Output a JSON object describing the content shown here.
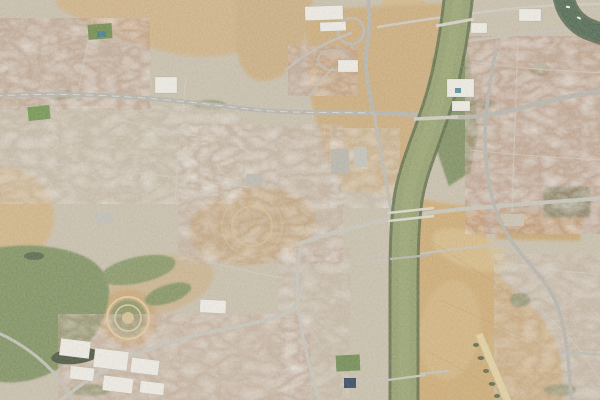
{
  "scene": {
    "type": "satellite-imagery-tile",
    "alt": "Aerial satellite view of a city crossed vertically by an olive-green river; dense rooftops on both banks, a large dry field with a runway strip southeast of the river, parks and ponds to the southwest, highway interchanges north and east, and five bridges crossing the river",
    "palette": {
      "urban_base": "#cbc2ae",
      "sand": "#cfae7c",
      "sand_light": "#dcc28e",
      "field": "#d0ad75",
      "dirt": "#c9a772",
      "river": "#94a06d",
      "river_trees": "#5c6c45",
      "dark_water": "#4d6750",
      "park": "#83945c",
      "park_dark": "#55693f",
      "pond": "#46523c",
      "road": "#c9c7bd",
      "highway": "#b7b6ae",
      "bridge": "#dcdad0",
      "building_white": "#f1efe7",
      "roof_red": "#bc9480",
      "runway": "#e4d2a2"
    },
    "features": {
      "river": "river channel",
      "old_river_arm": "dark water arm, top right",
      "bridge_count": 5,
      "dry_field": "large dry field with runway strip",
      "park_with_ponds": "green park and golf area, southwest",
      "ring_park": "circular park with concentric paths",
      "interchange": "highway interchange, top center",
      "warehouse_district": "white warehouse roofs, bottom left"
    }
  }
}
